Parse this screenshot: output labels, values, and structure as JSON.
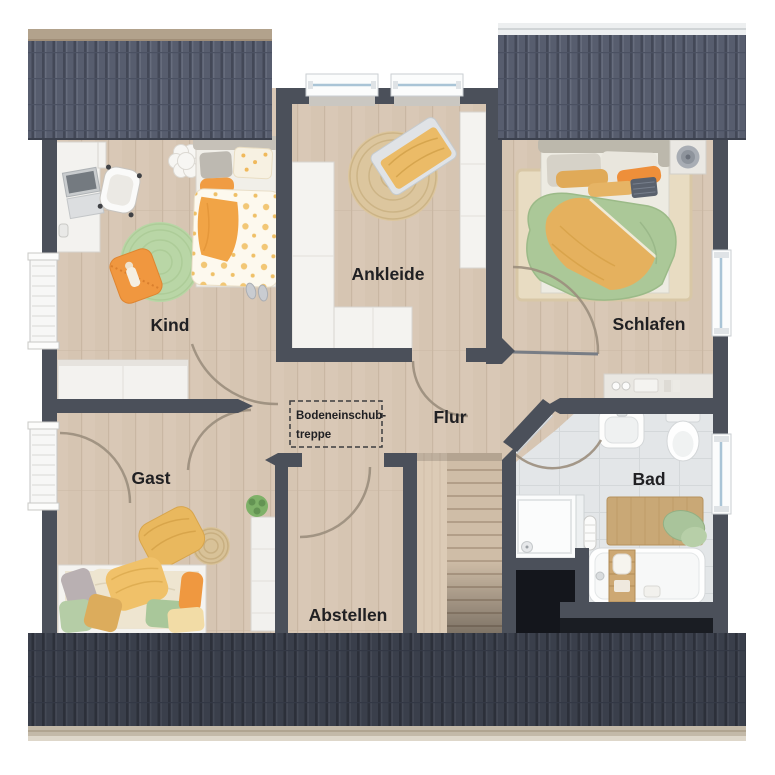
{
  "rooms": {
    "kind": {
      "label": "Kind"
    },
    "ankleide": {
      "label": "Ankleide"
    },
    "schlafen": {
      "label": "Schlafen"
    },
    "gast": {
      "label": "Gast"
    },
    "flur": {
      "label": "Flur"
    },
    "bad": {
      "label": "Bad"
    },
    "abstellen": {
      "label": "Abstellen"
    }
  },
  "annotation": {
    "line1": "Bodeneinschub-",
    "line2": "treppe"
  },
  "palette": {
    "wall": "#4b505a",
    "floor_wood": "#d9c8b6",
    "floor_tile": "#e3e6e8",
    "roof_upper": "#575d6e",
    "roof_lower": "#3a3f4b",
    "gutter_tan": "#b2a28c",
    "accent_orange": "#ef9640",
    "accent_ochre": "#e5b264",
    "duvet_green": "#abc898",
    "rug_green": "#b9d6a6",
    "jute": "#dcc69e",
    "furniture_white": "#f3f2ef",
    "void_black": "#14161c"
  }
}
